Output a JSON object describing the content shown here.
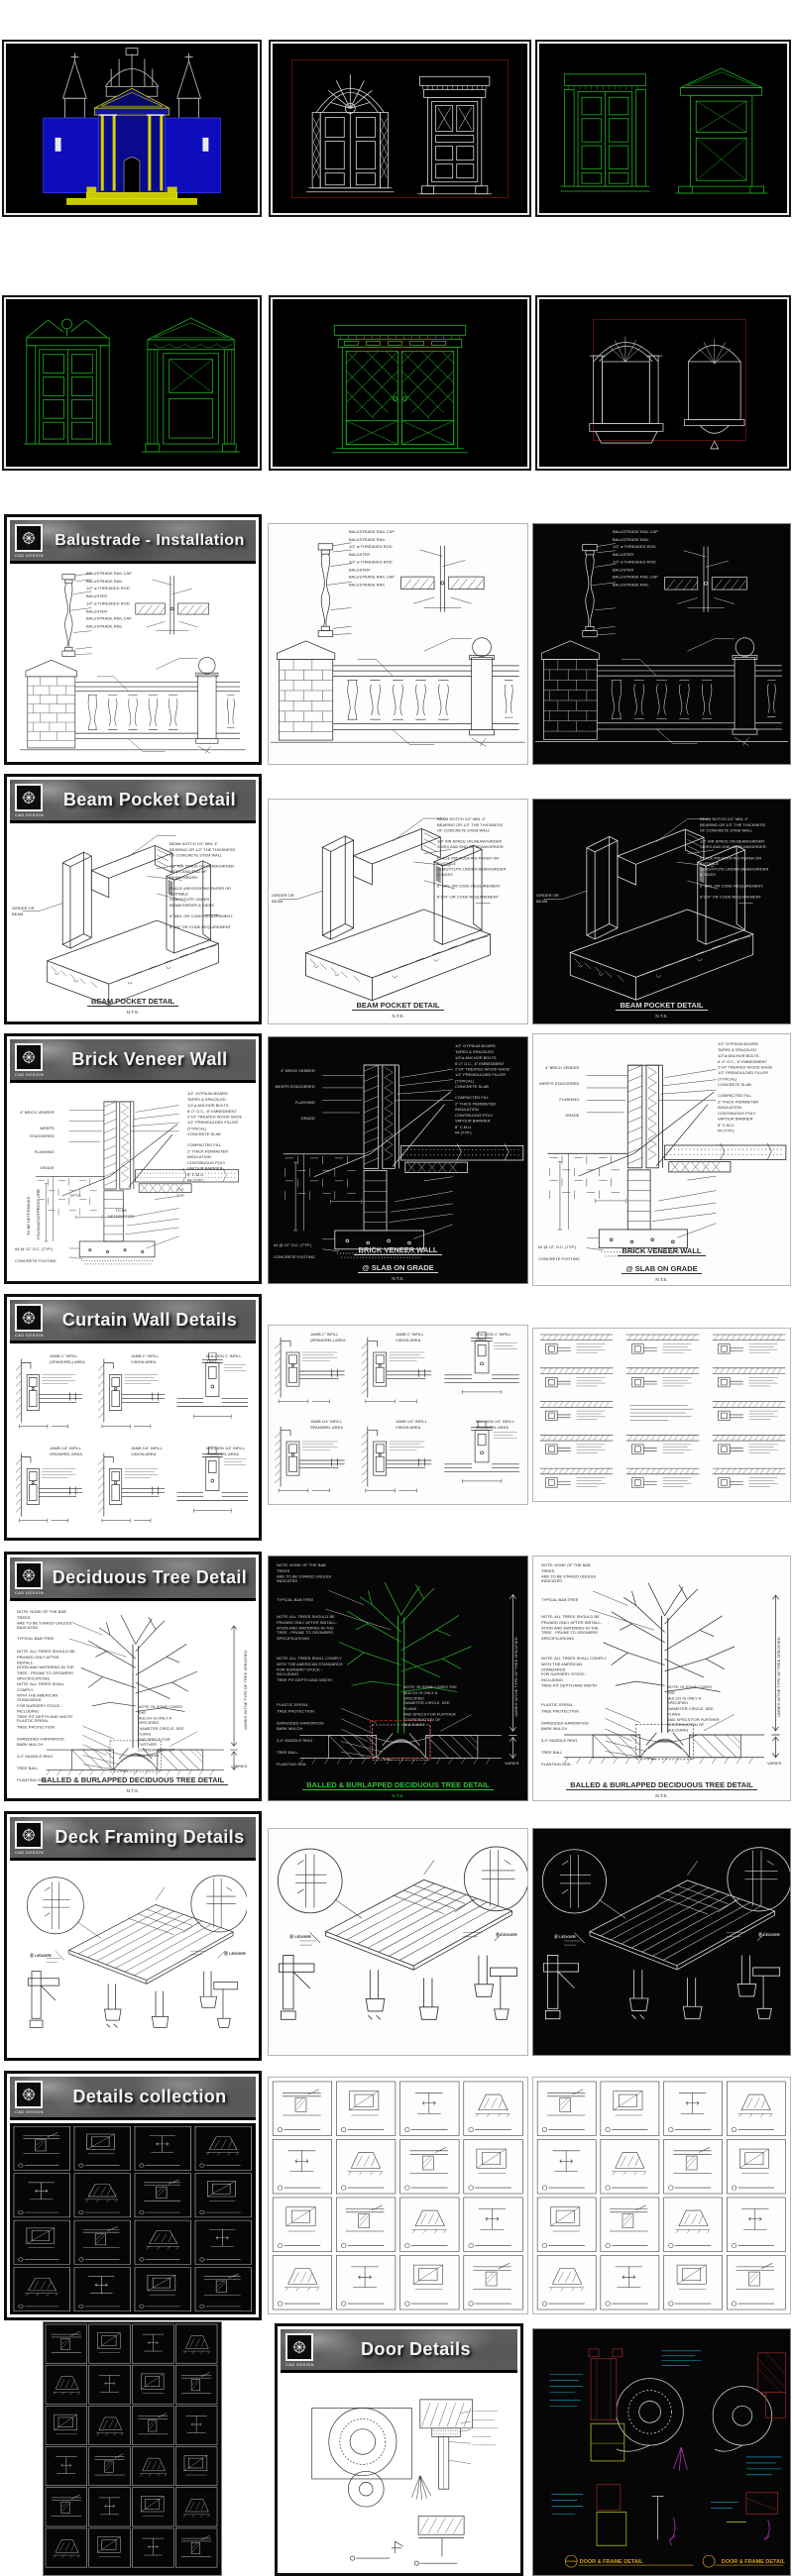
{
  "brand": {
    "logo_text": "CAD DESIGN"
  },
  "colors": {
    "cad_green": "#1fb41f",
    "cad_blue": "#0d0dbb",
    "cad_yellow": "#c9c900",
    "frame_red": "#571010",
    "caption_orange": "#d8a020"
  },
  "sheets": {
    "balustrade": {
      "title": "Balustrade - Installation",
      "ann_right": "BALUSTRADE RAIL CAP\nBALUSTRADE RAIL\n1/2\" ø THREADED ROD\nBALUSTER\n1/2\" ø THREADED ROD\nBALUSTER\nBALUSTRADE RAIL CAP\nBALUSTRADE RAIL"
    },
    "beam_pocket": {
      "title": "Beam Pocket Detail",
      "caption": "BEAM POCKET DETAIL",
      "nts": "N.T.S.",
      "ann_left": "GIRDER OR BEAM",
      "ann_right": "BEAM NOTCH 1/2\" MIN. 4\"\nBEARING OR 1/2\" THE THICKNESS\nOF CONCRETE STEM WALL\n\n1/2\" AIR SPACE ON BEAM/GIRDER\nSIDES AND END OF BEAM/GIRDER.\n\nPLACE #55 ROOFING PAPER OR SUITABLE\nSUBSTITUTE UNDER BEAM/GIRDER & SIDES\n\n6\" MIN. OR CODE REQUIREMENT.\n\n8\"x24\" OR CODE REQUIREMENT"
    },
    "brick_veneer": {
      "title": "Brick Veneer Wall",
      "caption1": "BRICK VENEER WALL",
      "caption2": "@ SLAB ON GRADE",
      "nts": "N.T.S.",
      "ann_left_top": "4\" BRICK VENEER\n\nWEEPS STAGGERED\n\nFLASHING\n\nGRADE",
      "ann_left_bottom": "#4 @ 12\" O.C. (TYP.)\n\nCONCRETE FOOTING",
      "ann_right": "1/2\" GYPSUM BOARD\nTAPED & SPACKLED\n1/2\"ø ANCHOR BOLTS\n6'-0\" O.C., 8\" EMBEDMENT\n2\"x4\" TREATED WOOD SHOE\n1/2\" PREMOULDED FILLER\n(TYPICAL)\nCONCRETE SLAB\n\nCOMPACTED FILL\n2\" THICK PERIMETER\nINSULATION\nCONTINUOUS POLY\nVAPOUR BARRIER\n8\" C.M.U.\n#4 (TYP.)",
      "vlab1": "TO BE DETERMINED",
      "vlab2": "FOUNDATION FROST LINE",
      "lab_tftg": "T/FTG",
      "lab_tbd": "TO BE\nDETERMINED",
      "lab_typ": "2'-0\"\nTYP."
    },
    "curtain": {
      "title": "Curtain Wall Details",
      "labels": [
        "JAMB 1\" INFILL\n(SPANDREL) AREA",
        "JAMB 1\" INFILL\nVISION AREA",
        "MULLION 1\" INFILL\nAREA",
        "JAMB 1/4\" INFILL\nSPANDREL AREA",
        "JAMB 1/4\" INFILL\nVISION AREA",
        "MULLION 1/4\" INFILL\nSPANDREL AREA"
      ]
    },
    "tree": {
      "title": "Deciduous Tree Detail",
      "note1": "NOTE: NONE OF THE B&B TREES\nARE TO BE STAKED UNLESS\nINDICATED",
      "lab_tree": "TYPICAL B&B TREE",
      "note2": "NOTE: ALL TREES SHOULD BE\nPRUNED ONLY AFTER INSTALL-\nATION AND WATERING-IN THE\nTREE - PRUNE TO GROWERS\nSPECIFICATIONS",
      "note3": "NOTE: ALL TREES SHALL COMPLY\nWITH THE AMERICAN STANDARDS\nFOR NURSERY STOCK - INCLUDING\nTREE PIT DEPTH AND WIDTH",
      "note4": "NOTE: IN SOME CASES THE\nMULCH IS ONLY A SPECIFIED\nDIAMETER CIRCLE. SEE PLANS\nAND SPECS FOR FURTHER\nCOORDINATION OF MULCHING",
      "ann_bottom": "PLASTIC SPIRAL\nTREE PROTECTION\n\nSHREDDED HARDWOOD\nBARK MULCH\n\n3-4\" MUDDLE RING\n\nTREE BALL\n\nPLANTING SOIL",
      "vlab": "VARIES W/THE TYPE OF TREE SPECIFIED",
      "lab_varies": "VARIES",
      "caption": "BALLED & BURLAPPED DECIDUOUS TREE DETAIL",
      "nts": "N.T.S."
    },
    "deck": {
      "title": "Deck Framing Details",
      "lab_a": "Ⓐ LEDGER",
      "lab_b": "Ⓑ LEDGER"
    },
    "details": {
      "title": "Details collection"
    },
    "door": {
      "title": "Door Details",
      "caption": "DOOR & FRAME DETAIL"
    }
  }
}
